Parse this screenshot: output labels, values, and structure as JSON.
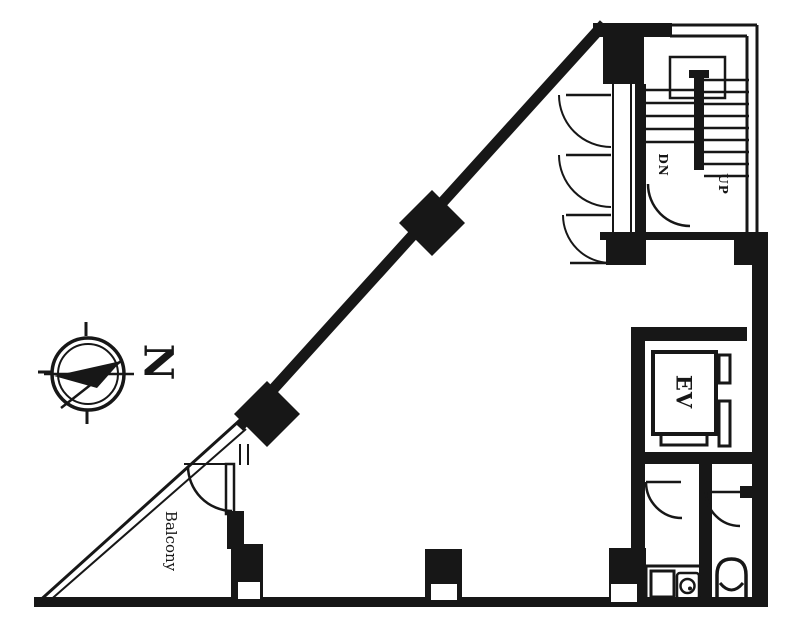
{
  "meta": {
    "drawing_type": "architectural floor plan, scanned black-and-white",
    "shape": "right-triangle shaped building footprint with service core on east side"
  },
  "colors": {
    "ink": "#1c1c1c",
    "paper": "#ffffff"
  },
  "labels": {
    "north": "N",
    "balcony": "Balcony",
    "elevator": "EV",
    "stair_down": "DN",
    "stair_up": "UP"
  }
}
